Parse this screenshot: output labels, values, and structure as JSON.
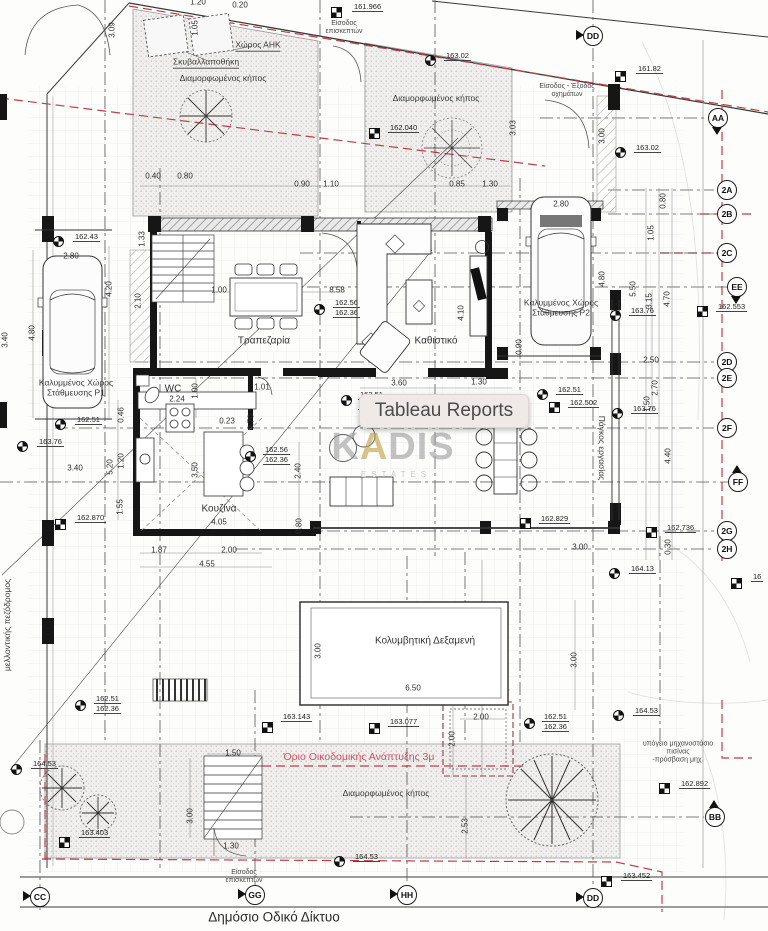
{
  "overlay": {
    "tooltip": "Tableau Reports"
  },
  "watermark": {
    "pre": "K",
    "accent": "A",
    "post": "DIS",
    "sub": "ESTATES",
    "accent_color": "#c09b42"
  },
  "colors": {
    "boundary_red": "#c63a44",
    "limit_text_red": "#cf5360",
    "plan_line": "#333333",
    "tooltip_bg": "#efe9e8"
  },
  "plan": {
    "texts": [
      {
        "t": "1.20",
        "x": 198,
        "y": 3
      },
      {
        "t": "0.20",
        "x": 240,
        "y": 6
      },
      {
        "t": "3.09",
        "x": 113,
        "y": 30,
        "r": -90
      },
      {
        "t": "1.05",
        "x": 196,
        "y": 28,
        "r": -90
      },
      {
        "t": "Χώρος ΑΗΚ",
        "x": 258,
        "y": 46,
        "c": "rs",
        "u": 1
      },
      {
        "t": "Σκυβαλλαποθήκη",
        "x": 206,
        "y": 63,
        "c": "rs",
        "u": 1
      },
      {
        "t": "Διαμορφωμένος κήπος",
        "x": 223,
        "y": 79,
        "c": "rs"
      },
      {
        "t": "Είσοδος\nεπισκεπτών",
        "x": 344,
        "y": 28,
        "c": "xs"
      },
      {
        "t": "Διαμορφωμένος κήπος",
        "x": 436,
        "y": 99,
        "c": "rs"
      },
      {
        "t": "Είσοδος - Έξοδος\nοχημάτων",
        "x": 567,
        "y": 91,
        "c": "xs"
      },
      {
        "t": "3.03",
        "x": 514,
        "y": 128,
        "r": -90
      },
      {
        "t": "3.00",
        "x": 603,
        "y": 136,
        "r": -90
      },
      {
        "t": "0.40",
        "x": 153,
        "y": 177
      },
      {
        "t": "0.80",
        "x": 185,
        "y": 177
      },
      {
        "t": "0.90",
        "x": 302,
        "y": 185
      },
      {
        "t": "1.10",
        "x": 331,
        "y": 185
      },
      {
        "t": "0.85",
        "x": 457,
        "y": 185
      },
      {
        "t": "1.30",
        "x": 490,
        "y": 185
      },
      {
        "t": "0.80",
        "x": 664,
        "y": 201,
        "r": -90
      },
      {
        "t": "1.05",
        "x": 652,
        "y": 233,
        "r": -90
      },
      {
        "t": "2.80",
        "x": 71,
        "y": 257
      },
      {
        "t": "2.80",
        "x": 561,
        "y": 205
      },
      {
        "t": "1.33",
        "x": 143,
        "y": 239,
        "r": -90
      },
      {
        "t": "2.10",
        "x": 139,
        "y": 301,
        "r": -90
      },
      {
        "t": "4.20",
        "x": 110,
        "y": 289,
        "r": -90
      },
      {
        "t": "4.80",
        "x": 33,
        "y": 333,
        "r": -90
      },
      {
        "t": "3.40",
        "x": 6,
        "y": 340,
        "r": -90
      },
      {
        "t": "1.00",
        "x": 219,
        "y": 291
      },
      {
        "t": "8.58",
        "x": 337,
        "y": 291
      },
      {
        "t": "Τραπεζαρία",
        "x": 264,
        "y": 341,
        "c": "room"
      },
      {
        "t": "Καθιστικό",
        "x": 436,
        "y": 341,
        "c": "room"
      },
      {
        "t": "4.10",
        "x": 462,
        "y": 313,
        "r": -90
      },
      {
        "t": "0.90",
        "x": 520,
        "y": 347,
        "r": -90
      },
      {
        "t": "Καλυμμένος Χώρος\nΣτάθμευσης P1",
        "x": 76,
        "y": 388,
        "c": "rs"
      },
      {
        "t": "Καλυμμένος Χώρος\nΣτάθμευσης P2",
        "x": 561,
        "y": 308,
        "c": "rs"
      },
      {
        "t": "4.80",
        "x": 603,
        "y": 279,
        "r": -90
      },
      {
        "t": "5.50",
        "x": 634,
        "y": 289,
        "r": -90
      },
      {
        "t": "3.15",
        "x": 650,
        "y": 301,
        "r": -90
      },
      {
        "t": "4.70",
        "x": 668,
        "y": 299,
        "r": -90
      },
      {
        "t": "WC",
        "x": 173,
        "y": 389,
        "c": "room"
      },
      {
        "t": "2.24",
        "x": 177,
        "y": 400
      },
      {
        "t": "1.00",
        "x": 196,
        "y": 391,
        "r": -90
      },
      {
        "t": "1.01",
        "x": 262,
        "y": 388
      },
      {
        "t": "0.70",
        "x": 252,
        "y": 422,
        "r": -90
      },
      {
        "t": "0.23",
        "x": 227,
        "y": 422
      },
      {
        "t": "3.60",
        "x": 399,
        "y": 384
      },
      {
        "t": "1.30",
        "x": 479,
        "y": 383
      },
      {
        "t": "3.50",
        "x": 196,
        "y": 470,
        "r": -90
      },
      {
        "t": "2.40",
        "x": 299,
        "y": 471,
        "r": -90
      },
      {
        "t": "0.80",
        "x": 300,
        "y": 526,
        "r": -90
      },
      {
        "t": "Κουζίνα",
        "x": 219,
        "y": 509,
        "c": "room"
      },
      {
        "t": "4.05",
        "x": 219,
        "y": 523
      },
      {
        "t": "0.46",
        "x": 122,
        "y": 415,
        "r": -90
      },
      {
        "t": "1.20",
        "x": 122,
        "y": 461,
        "r": -90
      },
      {
        "t": "5.20",
        "x": 111,
        "y": 467,
        "r": -90
      },
      {
        "t": "1.55",
        "x": 121,
        "y": 507,
        "r": -90
      },
      {
        "t": "3.40",
        "x": 75,
        "y": 469
      },
      {
        "t": "Πάγκος εργασίας",
        "x": 601,
        "y": 448,
        "r": 90,
        "c": "rs"
      },
      {
        "t": "2.50",
        "x": 651,
        "y": 361
      },
      {
        "t": "2.70",
        "x": 656,
        "y": 388,
        "r": -90
      },
      {
        "t": "1.50",
        "x": 648,
        "y": 404,
        "r": -90
      },
      {
        "t": "4.40",
        "x": 669,
        "y": 456,
        "r": -90
      },
      {
        "t": "0.30",
        "x": 669,
        "y": 547,
        "r": -90
      },
      {
        "t": "1.87",
        "x": 159,
        "y": 551
      },
      {
        "t": "2.00",
        "x": 229,
        "y": 551
      },
      {
        "t": "4.55",
        "x": 207,
        "y": 565
      },
      {
        "t": "3.00",
        "x": 580,
        "y": 548
      },
      {
        "t": "Κολυμβητική Δεξαμενή",
        "x": 425,
        "y": 641,
        "c": "room"
      },
      {
        "t": "3.00",
        "x": 319,
        "y": 651,
        "r": -90
      },
      {
        "t": "6.50",
        "x": 413,
        "y": 689
      },
      {
        "t": "2.00",
        "x": 481,
        "y": 718
      },
      {
        "t": "2.00",
        "x": 453,
        "y": 739,
        "r": -90
      },
      {
        "t": "3.00",
        "x": 575,
        "y": 660,
        "r": -90
      },
      {
        "t": "μελλοντικής πεζόδρομος",
        "x": 8,
        "y": 625,
        "r": -90,
        "c": "rs"
      },
      {
        "t": "Όριο Οικοδομικής Ανάπτυξης  3μ",
        "x": 359,
        "y": 758,
        "c": "red"
      },
      {
        "t": "Διαμορφωμένος κήπος",
        "x": 386,
        "y": 794,
        "c": "rs"
      },
      {
        "t": "υπόγειο μηχανοστάσιο πισίνας\n-πρόσβαση μηχ.",
        "x": 678,
        "y": 752,
        "c": "xs"
      },
      {
        "t": "1.50",
        "x": 233,
        "y": 754
      },
      {
        "t": "3.00",
        "x": 191,
        "y": 816,
        "r": -90
      },
      {
        "t": "2.53",
        "x": 466,
        "y": 826,
        "r": -90
      },
      {
        "t": "1.30",
        "x": 231,
        "y": 847
      },
      {
        "t": "Είσοδος\nεπισκεπτών",
        "x": 244,
        "y": 877,
        "c": "xs"
      },
      {
        "t": "Δημόσιο Οδικό Δίκτυο",
        "x": 274,
        "y": 917,
        "c": "road"
      }
    ],
    "markers": [
      {
        "k": "ch",
        "x": 336,
        "y": 12,
        "lines": [
          "161.966"
        ],
        "lx": 352,
        "ly": 2
      },
      {
        "k": "ci",
        "x": 430,
        "y": 60,
        "lines": [
          "163.02"
        ],
        "lx": 444,
        "ly": 51
      },
      {
        "k": "ch",
        "x": 620,
        "y": 76,
        "lines": [
          "161.82"
        ],
        "lx": 636,
        "ly": 64
      },
      {
        "k": "ch",
        "x": 374,
        "y": 133,
        "lines": [
          "162.040"
        ],
        "lx": 388,
        "ly": 123
      },
      {
        "k": "ci",
        "x": 620,
        "y": 152,
        "lines": [
          "163.02"
        ],
        "lx": 634,
        "ly": 143
      },
      {
        "k": "ci",
        "x": 58,
        "y": 241,
        "lines": [
          "162.43"
        ],
        "lx": 73,
        "ly": 232
      },
      {
        "k": "ci",
        "x": 319,
        "y": 309,
        "lines": [
          "162.56",
          "162.36"
        ],
        "lx": 333,
        "ly": 298
      },
      {
        "k": "ci",
        "x": 615,
        "y": 315,
        "lines": [
          "163.76"
        ],
        "lx": 629,
        "ly": 306
      },
      {
        "k": "ch",
        "x": 702,
        "y": 311,
        "lines": [
          "162.553"
        ],
        "lx": 716,
        "ly": 302
      },
      {
        "k": "ci",
        "x": 60,
        "y": 424,
        "lines": [
          "162.51"
        ],
        "lx": 75,
        "ly": 415
      },
      {
        "k": "ci",
        "x": 22,
        "y": 446,
        "lines": [
          "163.76"
        ],
        "lx": 37,
        "ly": 437
      },
      {
        "k": "ci",
        "x": 250,
        "y": 456,
        "lines": [
          "162.56",
          "162.36"
        ],
        "lx": 263,
        "ly": 445
      },
      {
        "k": "ci",
        "x": 346,
        "y": 400,
        "lines": [
          "162.51",
          "162.36"
        ],
        "lx": 358,
        "ly": 390
      },
      {
        "k": "ci",
        "x": 542,
        "y": 394,
        "lines": [
          "162.51"
        ],
        "lx": 556,
        "ly": 385
      },
      {
        "k": "ch",
        "x": 554,
        "y": 407,
        "lines": [
          "162.502"
        ],
        "lx": 568,
        "ly": 398
      },
      {
        "k": "ci",
        "x": 617,
        "y": 413,
        "lines": [
          "163.76"
        ],
        "lx": 631,
        "ly": 404
      },
      {
        "k": "ch",
        "x": 60,
        "y": 524,
        "lines": [
          "162.870"
        ],
        "lx": 75,
        "ly": 513
      },
      {
        "k": "ch",
        "x": 651,
        "y": 532,
        "lines": [
          "162.736"
        ],
        "lx": 665,
        "ly": 523
      },
      {
        "k": "ci",
        "x": 614,
        "y": 573,
        "lines": [
          "164.13"
        ],
        "lx": 629,
        "ly": 564
      },
      {
        "k": "ch",
        "x": 736,
        "y": 583,
        "lines": [
          "16"
        ],
        "lx": 751,
        "ly": 572
      },
      {
        "k": "ch",
        "x": 525,
        "y": 523,
        "lines": [
          "162.829"
        ],
        "lx": 539,
        "ly": 514
      },
      {
        "k": "ch",
        "x": 267,
        "y": 727,
        "lines": [
          "163.143"
        ],
        "lx": 281,
        "ly": 712
      },
      {
        "k": "ch",
        "x": 374,
        "y": 728,
        "lines": [
          "163.077"
        ],
        "lx": 388,
        "ly": 717
      },
      {
        "k": "ci",
        "x": 80,
        "y": 705,
        "lines": [
          "162.51",
          "162.36"
        ],
        "lx": 94,
        "ly": 694
      },
      {
        "k": "ci",
        "x": 16,
        "y": 769,
        "lines": [
          "164.53"
        ],
        "lx": 31,
        "ly": 759
      },
      {
        "k": "ch",
        "x": 64,
        "y": 842,
        "lines": [
          "163.403"
        ],
        "lx": 79,
        "ly": 828
      },
      {
        "k": "ci",
        "x": 529,
        "y": 723,
        "lines": [
          "162.51",
          "162.36"
        ],
        "lx": 542,
        "ly": 712
      },
      {
        "k": "ci",
        "x": 618,
        "y": 715,
        "lines": [
          "164.53"
        ],
        "lx": 633,
        "ly": 706
      },
      {
        "k": "ch",
        "x": 664,
        "y": 788,
        "lines": [
          "162.892"
        ],
        "lx": 679,
        "ly": 779
      },
      {
        "k": "ch",
        "x": 606,
        "y": 881,
        "lines": [
          "163.452"
        ],
        "lx": 621,
        "ly": 871
      },
      {
        "k": "ci",
        "x": 339,
        "y": 861,
        "lines": [
          "164.53"
        ],
        "lx": 353,
        "ly": 852
      }
    ],
    "bubbles": [
      {
        "t": "DD",
        "x": 593,
        "y": 36,
        "d": "l"
      },
      {
        "t": "AA",
        "x": 718,
        "y": 118,
        "d": "d"
      },
      {
        "t": "2A",
        "x": 727,
        "y": 190
      },
      {
        "t": "2B",
        "x": 727,
        "y": 214
      },
      {
        "t": "2C",
        "x": 727,
        "y": 253
      },
      {
        "t": "EE",
        "x": 737,
        "y": 287,
        "d": "d"
      },
      {
        "t": "2D",
        "x": 727,
        "y": 362
      },
      {
        "t": "2E",
        "x": 727,
        "y": 378
      },
      {
        "t": "2F",
        "x": 727,
        "y": 428
      },
      {
        "t": "FF",
        "x": 738,
        "y": 482,
        "d": "u"
      },
      {
        "t": "2G",
        "x": 727,
        "y": 531
      },
      {
        "t": "2H",
        "x": 727,
        "y": 549
      },
      {
        "t": "BB",
        "x": 715,
        "y": 817,
        "d": "u"
      },
      {
        "t": "CC",
        "x": 40,
        "y": 897,
        "d": "l"
      },
      {
        "t": "GG",
        "x": 255,
        "y": 895,
        "d": "l"
      },
      {
        "t": "HH",
        "x": 407,
        "y": 895,
        "d": "l"
      },
      {
        "t": "DD",
        "x": 593,
        "y": 898,
        "d": "l"
      }
    ]
  }
}
